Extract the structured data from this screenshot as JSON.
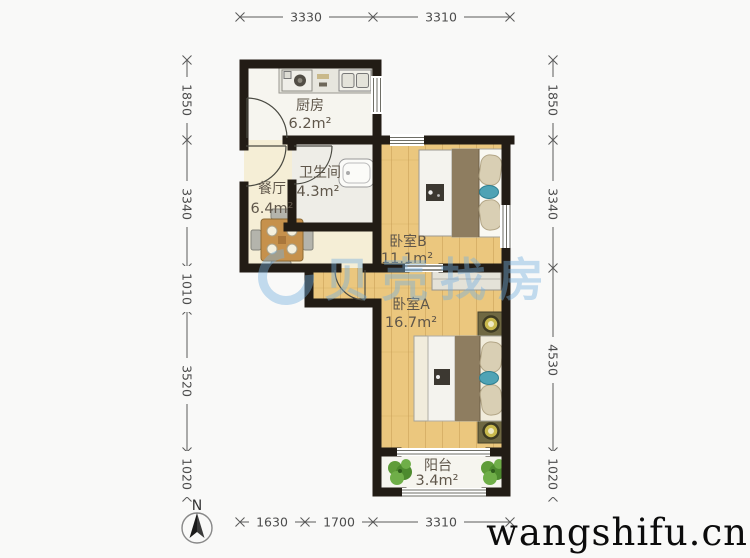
{
  "floorplan": {
    "rooms": [
      {
        "id": "kitchen",
        "name": "厨房",
        "area": "6.2m²"
      },
      {
        "id": "dining",
        "name": "餐厅",
        "area": "6.4m²"
      },
      {
        "id": "bathroom",
        "name": "卫生间",
        "area": "4.3m²"
      },
      {
        "id": "bedroom-b",
        "name": "卧室B",
        "area": "11.1m²"
      },
      {
        "id": "bedroom-a",
        "name": "卧室A",
        "area": "16.7m²"
      },
      {
        "id": "balcony",
        "name": "阳台",
        "area": "3.4m²"
      }
    ],
    "colors": {
      "wall": "#221c15",
      "wood_floor": "#ebc77e",
      "dining_floor": "#f5eed6",
      "watermark_blue": "#76afde"
    }
  },
  "dimensions": {
    "top": [
      "3330",
      "3310"
    ],
    "bottom": [
      "1630",
      "1700",
      "3310"
    ],
    "left": [
      "1850",
      "3340",
      "1010",
      "3520",
      "1020"
    ],
    "right": [
      "1850",
      "3340",
      "4530",
      "1020"
    ]
  },
  "compass": {
    "label": "N"
  },
  "watermarks": {
    "center": "贝壳找房",
    "corner": "wangshifu.cn"
  }
}
